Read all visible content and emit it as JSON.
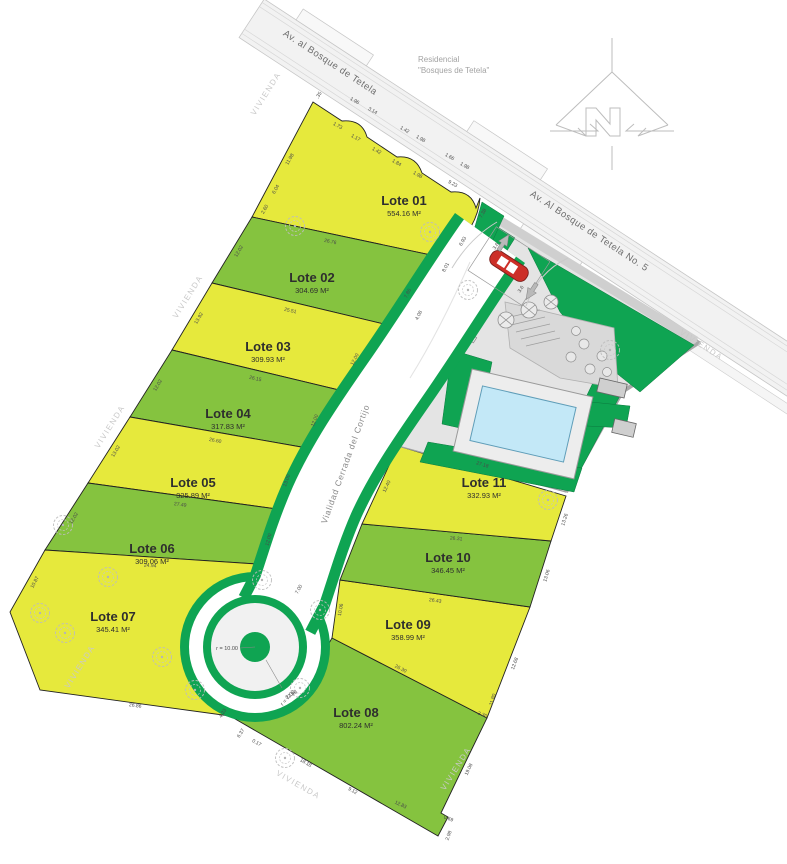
{
  "plan_title": "Residencial Bosques de Tetela - Plano de lotificacion",
  "roads": {
    "main_avenue_upper": "Av. al Bosque de Tetela",
    "main_avenue_lower": "Av. Al Bosque de Tetela No. 5",
    "internal_road": "Vialidad Cerrada del Cortijo"
  },
  "development_label": {
    "line1": "Residencial",
    "line2": "\"Bosques de Tetela\""
  },
  "cul_de_sac": {
    "outer_radius_label": "r = 10.00",
    "inner_radius_label": "r = 7.00"
  },
  "colors": {
    "lot_yellow": "#e6e93c",
    "lot_green": "#85c33f",
    "road_green": "#0fa452",
    "road_surface": "#f2f2f2",
    "pool_water": "#c3e8f7",
    "gate_red": "#cc2f28",
    "amenity_base": "#e4e4e4",
    "terrace_gray": "#d9d9d9"
  },
  "lots": [
    {
      "label": "Lote 01",
      "area": "554.16 M²",
      "color": "#e6e93c",
      "x": 404,
      "y": 205
    },
    {
      "label": "Lote 02",
      "area": "304.69 M²",
      "color": "#85c33f",
      "x": 312,
      "y": 282
    },
    {
      "label": "Lote 03",
      "area": "309.93 M²",
      "color": "#e6e93c",
      "x": 268,
      "y": 351
    },
    {
      "label": "Lote 04",
      "area": "317.83 M²",
      "color": "#85c33f",
      "x": 228,
      "y": 418
    },
    {
      "label": "Lote 05",
      "area": "325.89 M²",
      "color": "#e6e93c",
      "x": 193,
      "y": 487
    },
    {
      "label": "Lote 06",
      "area": "309.06 M²",
      "color": "#85c33f",
      "x": 152,
      "y": 553
    },
    {
      "label": "Lote 07",
      "area": "345.41 M²",
      "color": "#e6e93c",
      "x": 113,
      "y": 621
    },
    {
      "label": "Lote 08",
      "area": "802.24 M²",
      "color": "#85c33f",
      "x": 356,
      "y": 717
    },
    {
      "label": "Lote 09",
      "area": "358.99 M²",
      "color": "#e6e93c",
      "x": 408,
      "y": 629
    },
    {
      "label": "Lote 10",
      "area": "346.45 M²",
      "color": "#85c33f",
      "x": 448,
      "y": 562
    },
    {
      "label": "Lote 11",
      "area": "332.93 M²",
      "color": "#e6e93c",
      "x": 484,
      "y": 487
    }
  ],
  "dimensions": [
    {
      "t": ".35",
      "x": 320,
      "y": 96,
      "r": -58
    },
    {
      "t": "1.96",
      "x": 354,
      "y": 102,
      "r": 30
    },
    {
      "t": "3.14",
      "x": 372,
      "y": 112,
      "r": 30
    },
    {
      "t": "1.42",
      "x": 404,
      "y": 131,
      "r": 30
    },
    {
      "t": "1.98",
      "x": 420,
      "y": 140,
      "r": 30
    },
    {
      "t": "1.66",
      "x": 449,
      "y": 158,
      "r": 30
    },
    {
      "t": "1.98",
      "x": 464,
      "y": 167,
      "r": 30
    },
    {
      "t": "1.73",
      "x": 337,
      "y": 127,
      "r": 30
    },
    {
      "t": "1.17",
      "x": 355,
      "y": 139,
      "r": 30
    },
    {
      "t": "1.42",
      "x": 376,
      "y": 152,
      "r": 30
    },
    {
      "t": "1.84",
      "x": 396,
      "y": 164,
      "r": 30
    },
    {
      "t": "1.98",
      "x": 417,
      "y": 176,
      "r": 30
    },
    {
      "t": "9.23",
      "x": 452,
      "y": 185,
      "r": 30
    },
    {
      "t": "7.38",
      "x": 484,
      "y": 214,
      "r": -60
    },
    {
      "t": "6.93",
      "x": 464,
      "y": 242,
      "r": -60
    },
    {
      "t": "11.98",
      "x": 291,
      "y": 160,
      "r": -60
    },
    {
      "t": "6.04",
      "x": 277,
      "y": 190,
      "r": -60
    },
    {
      "t": "2.60",
      "x": 266,
      "y": 210,
      "r": -60
    },
    {
      "t": "12.02",
      "x": 240,
      "y": 252,
      "r": -59
    },
    {
      "t": "13.92",
      "x": 200,
      "y": 319,
      "r": -59
    },
    {
      "t": "12.02",
      "x": 159,
      "y": 386,
      "r": -59
    },
    {
      "t": "13.02",
      "x": 117,
      "y": 452,
      "r": -59
    },
    {
      "t": "12.02",
      "x": 75,
      "y": 519,
      "r": -59
    },
    {
      "t": "10.87",
      "x": 36,
      "y": 583,
      "r": -62
    },
    {
      "t": "26.86",
      "x": 135,
      "y": 707,
      "r": 8
    },
    {
      "t": "26.76",
      "x": 330,
      "y": 243,
      "r": 12
    },
    {
      "t": "25.51",
      "x": 290,
      "y": 312,
      "r": 13
    },
    {
      "t": "26.15",
      "x": 255,
      "y": 380,
      "r": 13
    },
    {
      "t": "26.60",
      "x": 215,
      "y": 442,
      "r": 10
    },
    {
      "t": "27.49",
      "x": 180,
      "y": 506,
      "r": 8
    },
    {
      "t": "24.94",
      "x": 150,
      "y": 567,
      "r": 4
    },
    {
      "t": "7.86",
      "x": 409,
      "y": 294,
      "r": -63
    },
    {
      "t": "8.01",
      "x": 447,
      "y": 268,
      "r": -63
    },
    {
      "t": "4.08",
      "x": 420,
      "y": 316,
      "r": -63
    },
    {
      "t": "12.00",
      "x": 356,
      "y": 360,
      "r": -63
    },
    {
      "t": "12.00",
      "x": 316,
      "y": 421,
      "r": -68
    },
    {
      "t": "13.00",
      "x": 288,
      "y": 481,
      "r": -70
    },
    {
      "t": "12.00",
      "x": 270,
      "y": 540,
      "r": -75
    },
    {
      "t": "7.00",
      "x": 300,
      "y": 590,
      "r": -60
    },
    {
      "t": "3.6",
      "x": 497,
      "y": 247,
      "r": -57
    },
    {
      "t": "3.6",
      "x": 522,
      "y": 290,
      "r": -57
    },
    {
      "t": "27.18",
      "x": 482,
      "y": 466,
      "r": 17
    },
    {
      "t": "12.40",
      "x": 388,
      "y": 487,
      "r": -65
    },
    {
      "t": "13.26",
      "x": 566,
      "y": 520,
      "r": -72
    },
    {
      "t": "26.31",
      "x": 456,
      "y": 540,
      "r": 5
    },
    {
      "t": "13.06",
      "x": 548,
      "y": 576,
      "r": -74
    },
    {
      "t": "26.43",
      "x": 435,
      "y": 602,
      "r": 8
    },
    {
      "t": "10.06",
      "x": 342,
      "y": 610,
      "r": -80
    },
    {
      "t": "12.68",
      "x": 516,
      "y": 664,
      "r": -70
    },
    {
      "t": "26.30",
      "x": 400,
      "y": 670,
      "r": 27
    },
    {
      "t": "22.99",
      "x": 292,
      "y": 696,
      "r": -30
    },
    {
      "t": "11.80",
      "x": 494,
      "y": 700,
      "r": -72
    },
    {
      "t": "3.30",
      "x": 482,
      "y": 716,
      "r": 20
    },
    {
      "t": "19.08",
      "x": 470,
      "y": 770,
      "r": -65
    },
    {
      "t": "12.83",
      "x": 400,
      "y": 806,
      "r": 25
    },
    {
      "t": "18.18",
      "x": 305,
      "y": 764,
      "r": 30
    },
    {
      "t": "9.12",
      "x": 352,
      "y": 792,
      "r": 30
    },
    {
      "t": "6.37",
      "x": 242,
      "y": 734,
      "r": -58
    },
    {
      "t": "0.17",
      "x": 256,
      "y": 744,
      "r": 30
    },
    {
      "t": "4.23",
      "x": 224,
      "y": 714,
      "r": -58
    },
    {
      "t": "0.69",
      "x": 448,
      "y": 820,
      "r": 20
    },
    {
      "t": "2.98",
      "x": 450,
      "y": 836,
      "r": -70
    }
  ],
  "watermarks": [
    {
      "t": "VIVIENDA",
      "x": 268,
      "y": 95,
      "r": -58
    },
    {
      "t": "VIVIENDA",
      "x": 190,
      "y": 298,
      "r": -58
    },
    {
      "t": "VIVIENDA",
      "x": 112,
      "y": 428,
      "r": -58
    },
    {
      "t": "VIVIENDA",
      "x": 82,
      "y": 668,
      "r": -58
    },
    {
      "t": "VIVIENDA",
      "x": 297,
      "y": 787,
      "r": 30
    },
    {
      "t": "VIVIENDA",
      "x": 458,
      "y": 770,
      "r": -58
    },
    {
      "t": "VIVIENDA",
      "x": 700,
      "y": 347,
      "r": 33
    }
  ],
  "trees": [
    {
      "x": 295,
      "y": 226
    },
    {
      "x": 430,
      "y": 232
    },
    {
      "x": 63,
      "y": 525
    },
    {
      "x": 40,
      "y": 613
    },
    {
      "x": 65,
      "y": 633
    },
    {
      "x": 162,
      "y": 657
    },
    {
      "x": 548,
      "y": 500
    },
    {
      "x": 195,
      "y": 690
    },
    {
      "x": 262,
      "y": 580
    },
    {
      "x": 320,
      "y": 610
    },
    {
      "x": 300,
      "y": 688
    },
    {
      "x": 285,
      "y": 758
    },
    {
      "x": 108,
      "y": 577
    },
    {
      "x": 610,
      "y": 350
    },
    {
      "x": 468,
      "y": 290
    }
  ]
}
